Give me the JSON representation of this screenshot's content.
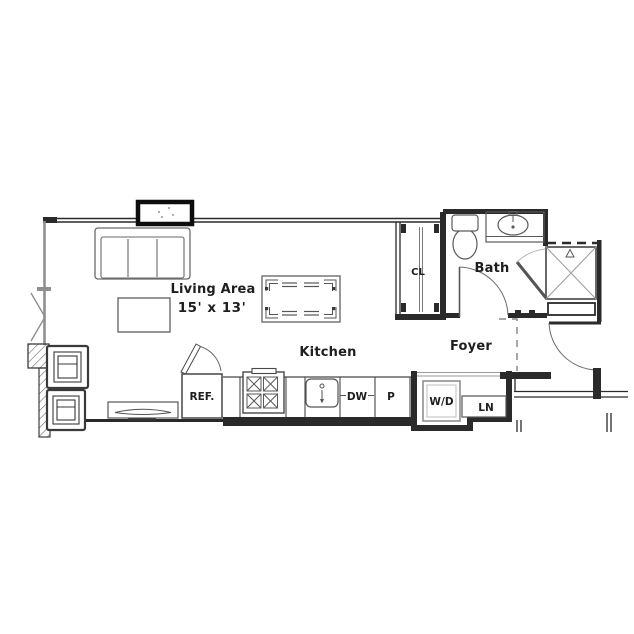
{
  "plan_type": "studio-apartment-floor-plan",
  "colors": {
    "background": "#ffffff",
    "wall": "#2a2a2a",
    "line_medium": "#555555",
    "line_light": "#8f8f8f"
  },
  "rooms": {
    "living_area": {
      "label": "Living Area",
      "dimensions": "15' x 13'"
    },
    "kitchen": {
      "label": "Kitchen"
    },
    "foyer": {
      "label": "Foyer"
    },
    "bath": {
      "label": "Bath"
    },
    "closet": {
      "label": "CL"
    }
  },
  "fixtures": {
    "refrigerator": {
      "label": "REF."
    },
    "dishwasher": {
      "label": "DW"
    },
    "pantry": {
      "label": "P"
    },
    "washer_dryer": {
      "label": "W/D"
    },
    "linen": {
      "label": "LN"
    }
  }
}
